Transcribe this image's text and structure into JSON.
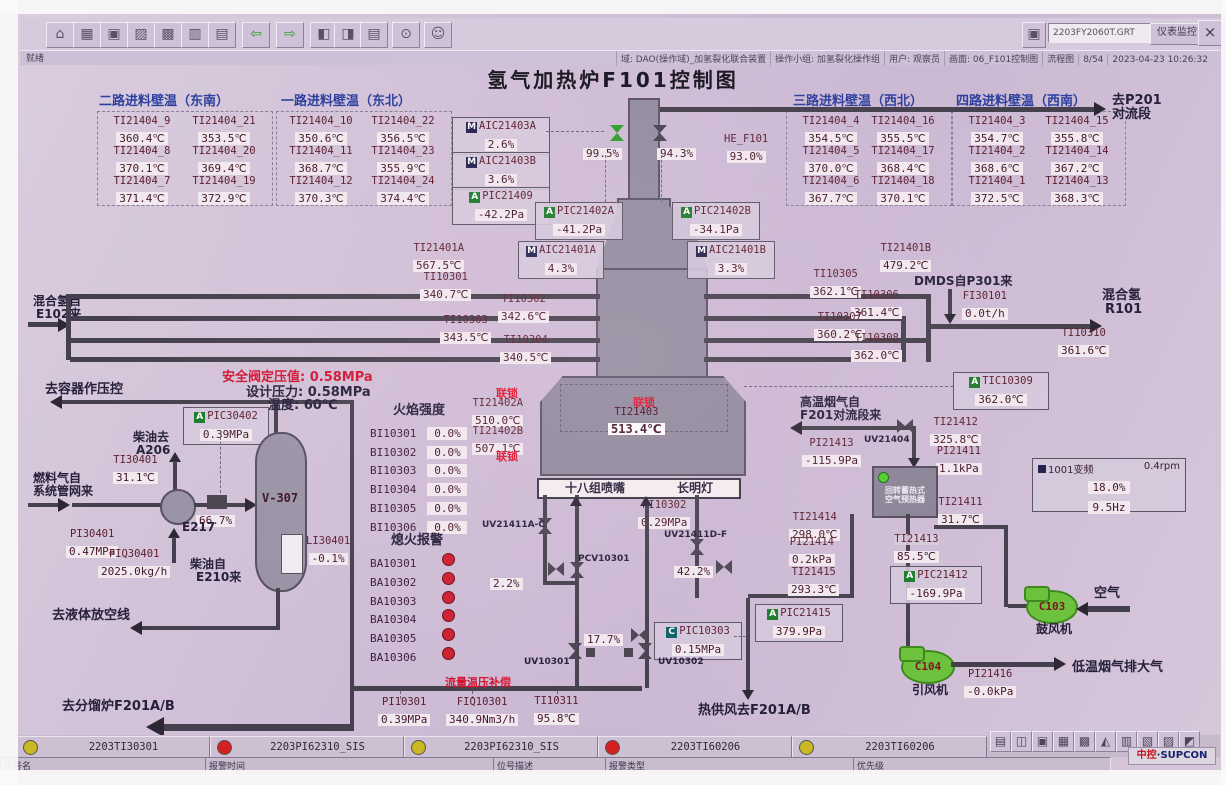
{
  "colors": {
    "accent_green": "#1c7c2c",
    "interlock_red": "#e01430",
    "fan_green": "#6cc23c",
    "alarm_red": "#d42020",
    "alarm_yellow": "#c9b822",
    "pipe": "#45404d"
  },
  "chrome": {
    "file_field": "2203FY2060T.GRT",
    "monitor_btn": "仪表监控",
    "close_btn": "×",
    "dd": "▾",
    "status_left": "就绪",
    "status_segs": [
      "域: DAO(操作域)_加氢裂化联合装置",
      "操作小组: 加氢裂化操作组",
      "用户: 观察员",
      "画面: 06_F101控制图",
      "流程图",
      "8/54",
      "2023-04-23 10:26:32"
    ],
    "tool_icons": [
      {
        "n": "home-icon",
        "g": "⌂"
      },
      {
        "n": "graphics-icon",
        "g": "▦"
      },
      {
        "n": "window-icon",
        "g": "▣"
      },
      {
        "n": "trend-icon",
        "g": "▨"
      },
      {
        "n": "group-display-icon",
        "g": "▩"
      },
      {
        "n": "faceplate-icon",
        "g": "▥"
      },
      {
        "n": "report-icon",
        "g": "▤"
      },
      {
        "n": "back-icon",
        "g": "⇦"
      },
      {
        "n": "forward-icon",
        "g": "⇨"
      },
      {
        "n": "page-prev-icon",
        "g": "◧"
      },
      {
        "n": "page-next-icon",
        "g": "◨"
      },
      {
        "n": "book-icon",
        "g": "▤"
      },
      {
        "n": "search-icon",
        "g": "⊙"
      },
      {
        "n": "user-icon",
        "g": "☺"
      }
    ]
  },
  "title": "氢气加热炉F101控制图",
  "groups": [
    {
      "title": "二路进料壁温（东南）",
      "cells": [
        [
          "TI21404_9",
          "360.4℃"
        ],
        [
          "TI21404_21",
          "353.5℃"
        ],
        [
          "TI21404_8",
          "370.1℃"
        ],
        [
          "TI21404_20",
          "369.4℃"
        ],
        [
          "TI21404_7",
          "371.4℃"
        ],
        [
          "TI21404_19",
          "372.9℃"
        ]
      ]
    },
    {
      "title": "一路进料壁温（东北）",
      "cells": [
        [
          "TI21404_10",
          "350.6℃"
        ],
        [
          "TI21404_22",
          "356.5℃"
        ],
        [
          "TI21404_11",
          "368.7℃"
        ],
        [
          "TI21404_23",
          "355.9℃"
        ],
        [
          "TI21404_12",
          "370.3℃"
        ],
        [
          "TI21404_24",
          "374.4℃"
        ]
      ]
    },
    {
      "title": "三路进料壁温（西北）",
      "cells": [
        [
          "TI21404_4",
          "354.5℃"
        ],
        [
          "TI21404_16",
          "355.5℃"
        ],
        [
          "TI21404_5",
          "370.0℃"
        ],
        [
          "TI21404_17",
          "368.4℃"
        ],
        [
          "TI21404_6",
          "367.7℃"
        ],
        [
          "TI21404_18",
          "370.1℃"
        ]
      ]
    },
    {
      "title": "四路进料壁温（西南）",
      "cells": [
        [
          "TI21404_3",
          "354.7℃"
        ],
        [
          "TI21404_15",
          "355.8℃"
        ],
        [
          "TI21404_2",
          "368.6℃"
        ],
        [
          "TI21404_14",
          "367.2℃"
        ],
        [
          "TI21404_1",
          "372.5℃"
        ],
        [
          "TI21404_13",
          "368.3℃"
        ]
      ]
    }
  ],
  "i": {
    "aic21403a": {
      "b": "M",
      "t": "AIC21403A",
      "v": "2.6%"
    },
    "aic21403b": {
      "b": "M",
      "t": "AIC21403B",
      "v": "3.6%"
    },
    "pic21409": {
      "b": "A",
      "t": "PIC21409",
      "v": "-42.2Pa"
    },
    "pic21402a": {
      "b": "A",
      "t": "PIC21402A",
      "v": "-41.2Pa"
    },
    "pic21402b": {
      "b": "A",
      "t": "PIC21402B",
      "v": "-34.1Pa"
    },
    "v995": {
      "v": "99.5%"
    },
    "v943": {
      "v": "94.3%"
    },
    "he_f101": {
      "t": "HE_F101",
      "v": "93.0%"
    },
    "aic21401a": {
      "b": "M",
      "t": "AIC21401A",
      "v": "4.3%"
    },
    "aic21401b": {
      "b": "M",
      "t": "AIC21401B",
      "v": "3.3%"
    },
    "ti21401a": {
      "t": "TI21401A",
      "v": "567.5℃"
    },
    "ti21401b": {
      "t": "TI21401B",
      "v": "479.2℃"
    },
    "ti10301": {
      "t": "TI10301",
      "v": "340.7℃"
    },
    "ti10302": {
      "t": "TI10302",
      "v": "342.6℃"
    },
    "ti10303": {
      "t": "TI10303",
      "v": "343.5℃"
    },
    "ti10304": {
      "t": "TI10304",
      "v": "340.5℃"
    },
    "ti10305": {
      "t": "TI10305",
      "v": "362.1℃"
    },
    "ti10306": {
      "t": "TI10306",
      "v": "361.4℃"
    },
    "ti10307": {
      "t": "TI10307",
      "v": "360.2℃"
    },
    "ti10308": {
      "t": "TI10308",
      "v": "362.0℃"
    },
    "fi30101": {
      "t": "FI30101",
      "v": "0.0t/h"
    },
    "ti10310": {
      "t": "TI10310",
      "v": "361.6℃"
    },
    "tic10309": {
      "b": "A",
      "t": "TIC10309",
      "v": "362.0℃"
    },
    "ti21402a": {
      "t": "TI21402A",
      "v": "510.0℃"
    },
    "ti21402b": {
      "t": "TI21402B",
      "v": "507.1℃"
    },
    "ti21403": {
      "t": "TI21403",
      "v": "513.4℃"
    },
    "pi10302": {
      "t": "PI10302",
      "v": "0.29MPa"
    },
    "pic10303": {
      "b": "C",
      "t": "PIC10303",
      "v": "0.15MPa"
    },
    "pi10301": {
      "t": "PI10301",
      "v": "0.39MPa"
    },
    "fiq10301": {
      "t": "FIQ10301",
      "v": "340.9Nm3/h"
    },
    "ti10311": {
      "t": "TI10311",
      "v": "95.8℃"
    },
    "pic30402": {
      "b": "A",
      "t": "PIC30402",
      "v": "0.39MPa"
    },
    "ti30401": {
      "t": "TI30401",
      "v": "31.1℃"
    },
    "pi30401": {
      "t": "PI30401",
      "v": "0.47MPa"
    },
    "fiq30401": {
      "t": "FIQ30401",
      "v": "2025.0kg/h"
    },
    "li30401": {
      "t": "LI30401",
      "v": "-0.1%"
    },
    "ti21412": {
      "t": "TI21412",
      "v": "325.8℃"
    },
    "pi21413": {
      "t": "PI21413",
      "v": "-115.9Pa"
    },
    "pi21411": {
      "t": "PI21411",
      "v": "1.1kPa"
    },
    "ti21411": {
      "t": "TI21411",
      "v": "31.7℃"
    },
    "ti21414": {
      "t": "TI21414",
      "v": "298.0℃"
    },
    "pi21414": {
      "t": "PI21414",
      "v": "0.2kPa"
    },
    "ti21415": {
      "t": "TI21415",
      "v": "293.3℃"
    },
    "pic21415": {
      "b": "A",
      "t": "PIC21415",
      "v": "379.9Pa"
    },
    "ti21413": {
      "t": "TI21413",
      "v": "85.5℃"
    },
    "pic21412": {
      "b": "A",
      "t": "PIC21412",
      "v": "-169.9Pa"
    },
    "pi21416": {
      "t": "PI21416",
      "v": "-0.0kPa"
    },
    "v667": {
      "v": "66.7%"
    },
    "v22": {
      "v": "2.2%"
    },
    "v422": {
      "v": "42.2%"
    },
    "v177": {
      "v": "17.7%"
    }
  },
  "vfd": {
    "t": "1001变频",
    "pct": "18.0%",
    "hz": "9.5Hz",
    "rpm": "0.4rpm"
  },
  "valve_labels": {
    "uv21411ac": "UV21411A-C",
    "uv21411df": "UV21411D-F",
    "pcv10301": "PCV10301",
    "uv10301": "UV10301",
    "uv10302": "UV10302",
    "uv21404": "UV21404"
  },
  "lbl": {
    "to_p201a": "去P201",
    "to_p201b": "对流段",
    "mix_in1": "混合氢自",
    "mix_in2": "E102来",
    "mix_out1": "混合氢",
    "mix_out2": "R101",
    "dmds": "DMDS自P301来",
    "interlock": "联锁",
    "flame_title": "火焰强度",
    "flameout_title": "熄火报警",
    "nozzle": "十八组喷嘴",
    "pilot": "长明灯",
    "comp": "流量温压补偿",
    "hot_air": "热供风去F201A/B",
    "to_vessel": "去容器作压控",
    "sv_set": "安全阀定压值: 0.58MPa",
    "design_p": "设计压力: 0.58MPa",
    "design_t": "温度: 60℃",
    "diesel_to1": "柴油去",
    "diesel_to2": "A206",
    "fuel_from1": "燃料气自",
    "fuel_from2": "系统管网来",
    "diesel_from1": "柴油自",
    "diesel_from2": "E210来",
    "e217": "E217",
    "v307": "V-307",
    "to_liquid": "去液体放空线",
    "to_frac": "去分馏炉F201A/B",
    "hot_flue1": "高温烟气自",
    "hot_flue2": "F201对流段来",
    "preh1": "回转蓄热式",
    "preh2": "空气预热器",
    "c103": "C103",
    "c104": "C104",
    "blower": "鼓风机",
    "idfan": "引风机",
    "air": "空气",
    "low_flue": "低温烟气排大气"
  },
  "flame": {
    "rows": [
      [
        "BI10301",
        "0.0%"
      ],
      [
        "BI10302",
        "0.0%"
      ],
      [
        "BI10303",
        "0.0%"
      ],
      [
        "BI10304",
        "0.0%"
      ],
      [
        "BI10305",
        "0.0%"
      ],
      [
        "BI10306",
        "0.0%"
      ]
    ]
  },
  "flameout": {
    "rows": [
      "BA10301",
      "BA10302",
      "BA10303",
      "BA10304",
      "BA10305",
      "BA10306"
    ]
  },
  "alarms": [
    {
      "c": "#c9b822",
      "tag": "2203TI30301"
    },
    {
      "c": "#d42020",
      "tag": "2203PI62310_SIS"
    },
    {
      "c": "#c9b822",
      "tag": "2203PI62310_SIS"
    },
    {
      "c": "#d42020",
      "tag": "2203TI60206"
    },
    {
      "c": "#c9b822",
      "tag": "2203TI60206"
    }
  ],
  "alarm_icons": [
    {
      "n": "printer-icon",
      "g": "▤"
    },
    {
      "n": "unlock-icon",
      "g": "◫"
    },
    {
      "n": "display-icon",
      "g": "▣"
    },
    {
      "n": "workstation-icon",
      "g": "▦"
    },
    {
      "n": "calculator-icon",
      "g": "▩"
    },
    {
      "n": "alarm-bell-icon",
      "g": "◭"
    },
    {
      "n": "list-icon",
      "g": "▥"
    },
    {
      "n": "report-page-icon",
      "g": "▧"
    },
    {
      "n": "tiles-icon",
      "g": "▨"
    },
    {
      "n": "speaker-icon",
      "g": "◩"
    }
  ],
  "footer": {
    "fields": [
      "位号名",
      "报警时间",
      "位号描述",
      "报警类型",
      "优先级"
    ],
    "brand1": "中控",
    "brand2": "·SUPCON"
  }
}
